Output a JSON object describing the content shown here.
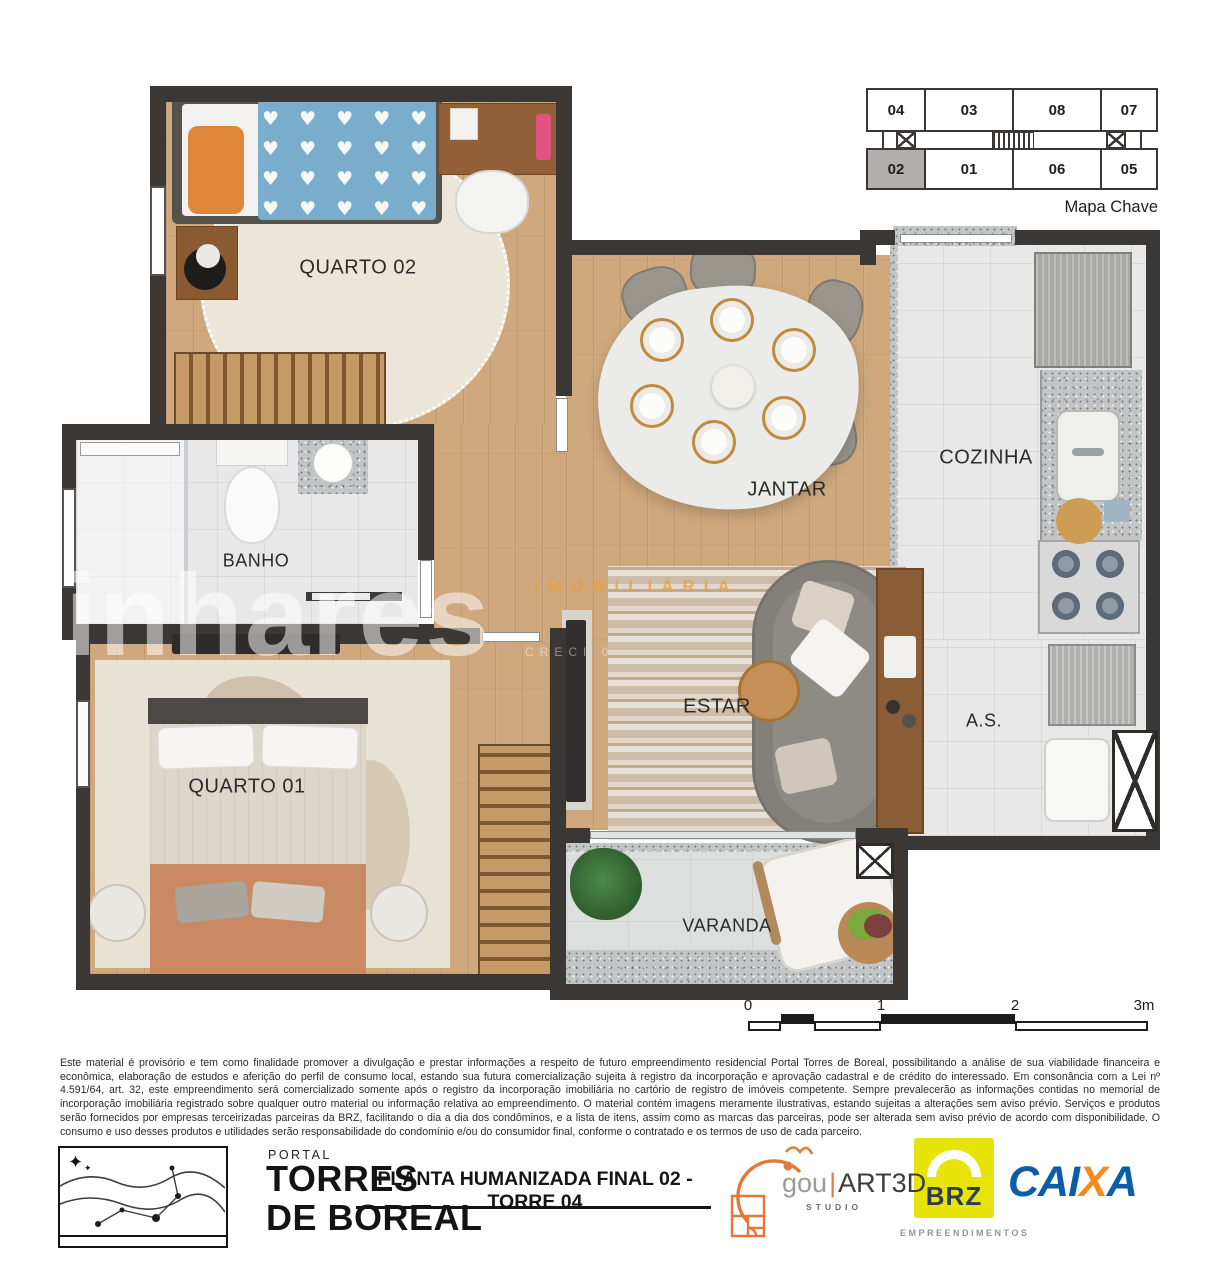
{
  "key_map": {
    "label": "Mapa Chave",
    "units_top": [
      "04",
      "03",
      "08",
      "07"
    ],
    "units_bottom": [
      "02",
      "01",
      "06",
      "05"
    ],
    "highlighted_unit": "02"
  },
  "rooms": {
    "quarto02": "QUARTO 02",
    "banho": "BANHO",
    "quarto01": "QUARTO 01",
    "jantar": "JANTAR",
    "cozinha": "COZINHA",
    "estar": "ESTAR",
    "area_servico": "A.S.",
    "varanda": "VARANDA"
  },
  "watermark": {
    "brand_top": "IMOBILIÁRIA",
    "brand_main": "Linhares",
    "creci": "CRECI 0"
  },
  "scale_bar": {
    "ticks": [
      "0",
      "1",
      "2",
      "3m"
    ]
  },
  "disclaimer": {
    "text": "Este material é provisório e tem como finalidade promover a divulgação e prestar informações a respeito de futuro empreendimento residencial Portal Torres de Boreal, possibilitando a análise de sua viabilidade financeira e econômica, elaboração de estudos e aferição do perfil de consumo local, estando sua futura comercialização sujeita à registro da incorporação e aprovação cadastral e de crédito do interessado. Em consonância com a Lei nº 4.591/64, art. 32, este empreendimento será comercializado somente após o registro da incorporação imobiliária no cartório de registro de imóveis competente. Sempre prevalecerão as informações contidas no memorial de incorporação imobiliária registrado sobre qualquer outro material ou informação relativa ao empreendimento. O material contém imagens meramente ilustrativas, estando sujeitas a alterações sem aviso prévio. Serviços e produtos serão fornecidos por empresas terceirizadas parceiras da BRZ, facilitando o dia a dia dos condôminos, e a lista de itens, assim como as marcas das parceiras, pode ser alterada sem aviso prévio de acordo com disponibilidade. O consumo e uso desses produtos e utilidades serão responsabilidade do condomínio e/ou do consumidor final, conforme o contratado e os termos de uso de cada parceiro."
  },
  "footer": {
    "portal": "PORTAL",
    "brand_line1": "TORRES",
    "brand_line2": "DE BOREAL",
    "plan_title": "PLANTA HUMANIZADA FINAL 02 - TORRE 04",
    "studio": {
      "part1": "gou",
      "part2": "ART3D",
      "sub": "STUDIO"
    },
    "developer": {
      "name": "BRZ",
      "sub": "EMPREENDIMENTOS"
    },
    "bank": {
      "part1": "CAI",
      "part2": "X",
      "part3": "A"
    }
  },
  "colors": {
    "wall": "#3b3734",
    "wood": "#cfa87d",
    "tile": "#e7e8e7",
    "brz_yellow": "#e8e409",
    "brz_navy": "#2e3c4f",
    "caixa_blue": "#0a5da6",
    "caixa_orange": "#f6891e",
    "studio_orange": "#e2793a",
    "watermark_orange": "#e8a33d"
  }
}
